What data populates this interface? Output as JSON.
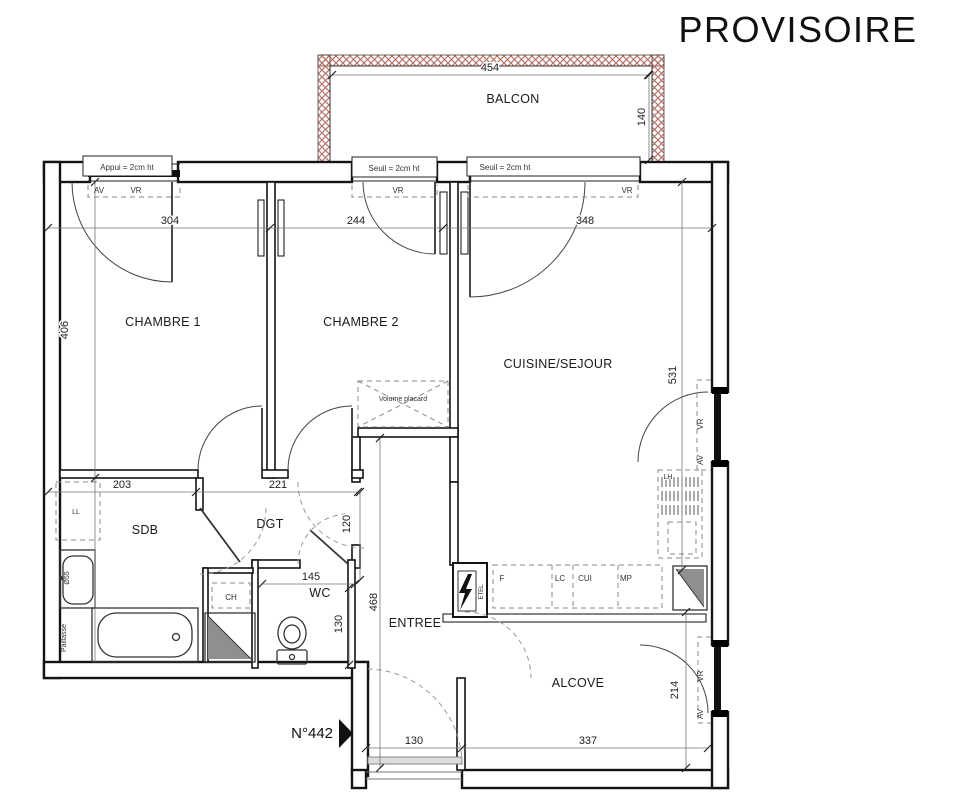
{
  "title": "PROVISOIRE",
  "unit_number": "N°442",
  "rooms": {
    "balcon": "BALCON",
    "chambre1": "CHAMBRE 1",
    "chambre2": "CHAMBRE 2",
    "cuisine_sejour": "CUISINE/SEJOUR",
    "sdb": "SDB",
    "dgt": "DGT",
    "wc": "WC",
    "entree": "ENTREE",
    "alcove": "ALCOVE"
  },
  "dimensions": {
    "balcon_width": "454",
    "balcon_depth": "140",
    "chambre1_width": "304",
    "chambre2_width": "244",
    "cuisine_width": "348",
    "chambre1_height": "406",
    "cuisine_height": "531",
    "sdb_width": "203",
    "dgt_width": "221",
    "dgt_height": "120",
    "wc_width": "145",
    "wc_height": "130",
    "entree_height": "468",
    "alcove_height": "214",
    "alcove_width": "337",
    "entrance_door_width": "130"
  },
  "annotations": {
    "appui": "Appui = 2cm ht",
    "seuil": "Seuil = 2cm ht",
    "av": "AV",
    "vr": "VR",
    "volume_placard": "Volume placard",
    "lave_linge": "LL",
    "chauffe_eau": "CH",
    "lh": "LH",
    "washbasin_diameter": "Ø55",
    "paillasse": "Paillasse",
    "kitchen_f": "F",
    "kitchen_lc": "LC",
    "kitchen_cui": "CUI",
    "kitchen_mp": "MP",
    "elec_panel": "ETEL"
  }
}
